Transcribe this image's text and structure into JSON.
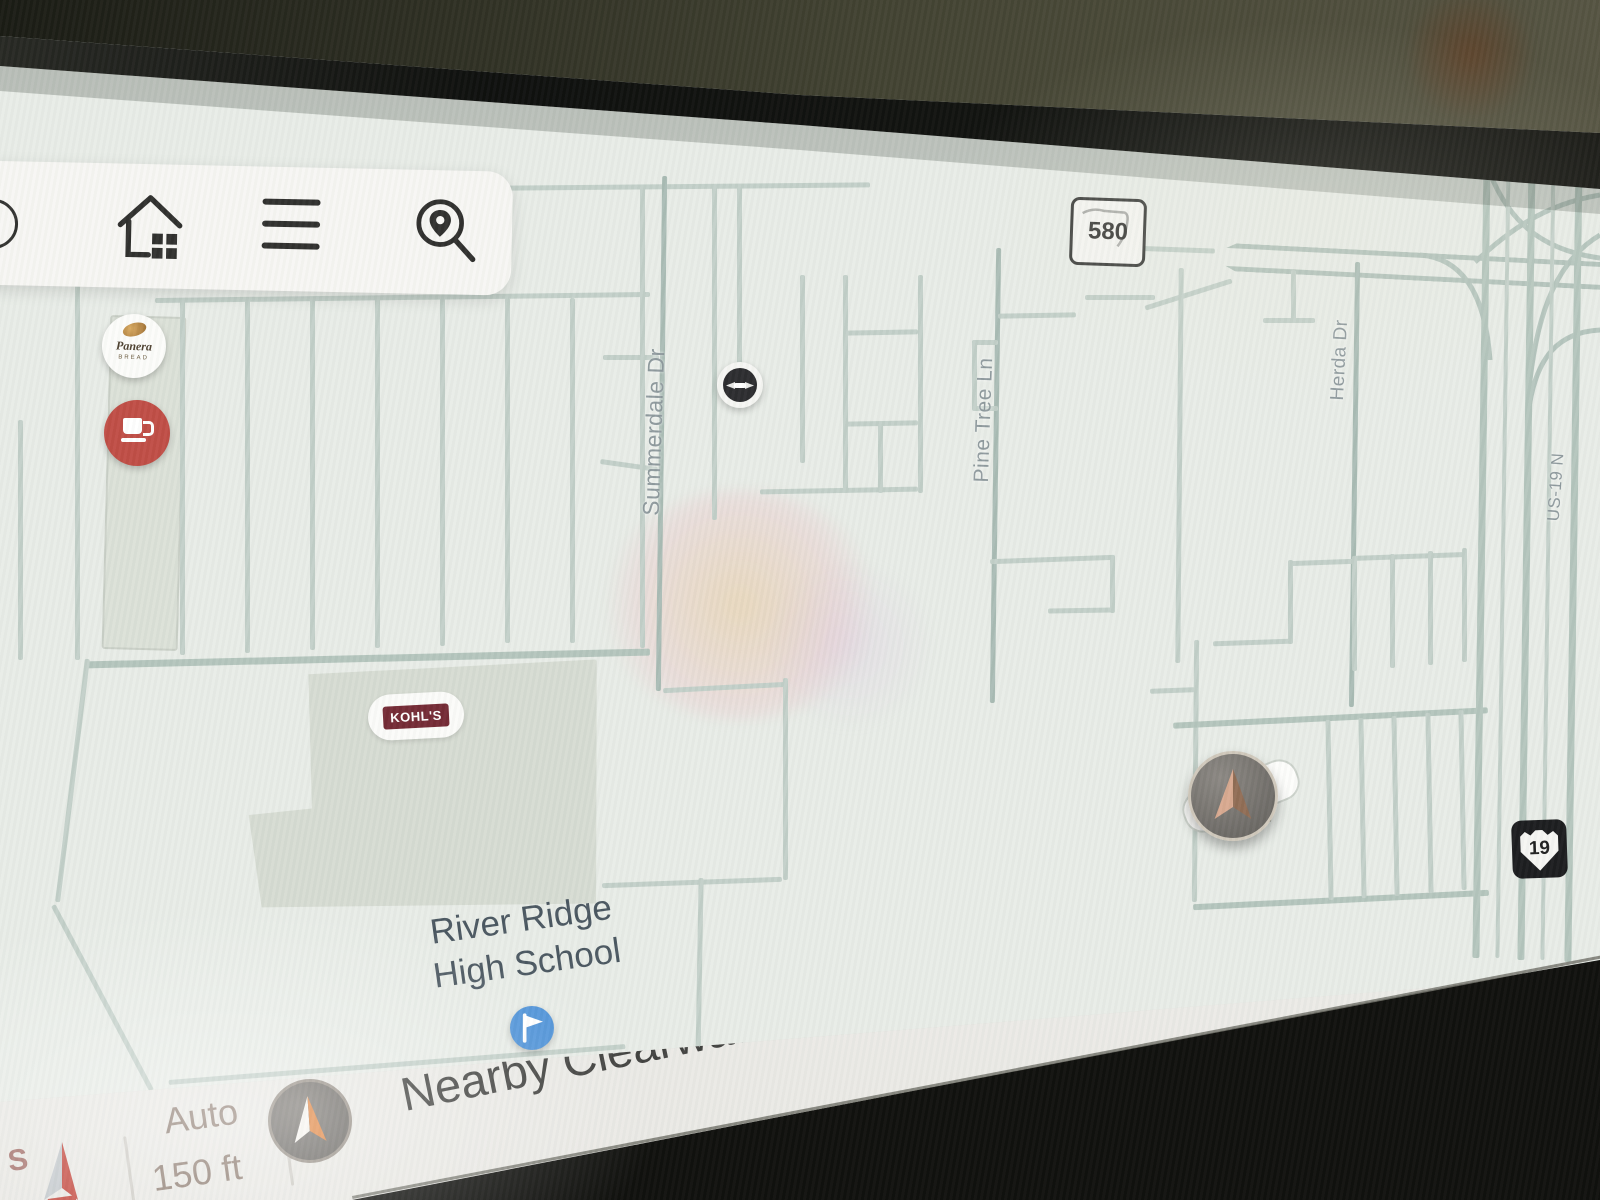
{
  "screen": {
    "type": "car-navigation-display"
  },
  "toolbar": {
    "icons": [
      {
        "name": "home"
      },
      {
        "name": "menu"
      },
      {
        "name": "search-location"
      }
    ]
  },
  "map": {
    "street_labels": [
      {
        "text": "Summerdale Dr"
      },
      {
        "text": "Pine Tree Ln"
      },
      {
        "text": "Herda Dr"
      },
      {
        "text": "US-19 N"
      }
    ],
    "route_shields": [
      {
        "system": "Florida State Road",
        "number": "580"
      },
      {
        "system": "US Route",
        "number": "19"
      }
    ],
    "pois": [
      {
        "name": "Panera Bread",
        "label_line1": "Panera",
        "label_line2": "BREAD"
      },
      {
        "name": "coffee-shop"
      },
      {
        "name": "business-badge"
      },
      {
        "name": "school-flag"
      }
    ],
    "places": [
      {
        "text": "KOHL'S"
      },
      {
        "line1": "River Ridge",
        "line2": "High School"
      }
    ]
  },
  "status_bar": {
    "compass_south_label": "S",
    "zoom_mode": "Auto",
    "zoom_scale": "150 ft",
    "location_text": "Nearby Clearwater, FL"
  },
  "colors": {
    "map_background": "#e8ece7",
    "road": "#c2cfc8",
    "road_major": "#b3c4bc",
    "coffee_marker": "#bf4a42",
    "school_marker": "#4e92d8",
    "kohls_brand": "#722631",
    "street_label": "#8d989c",
    "bar_text": "#3e3e3c",
    "zoom_text": "#8c7a6f"
  }
}
